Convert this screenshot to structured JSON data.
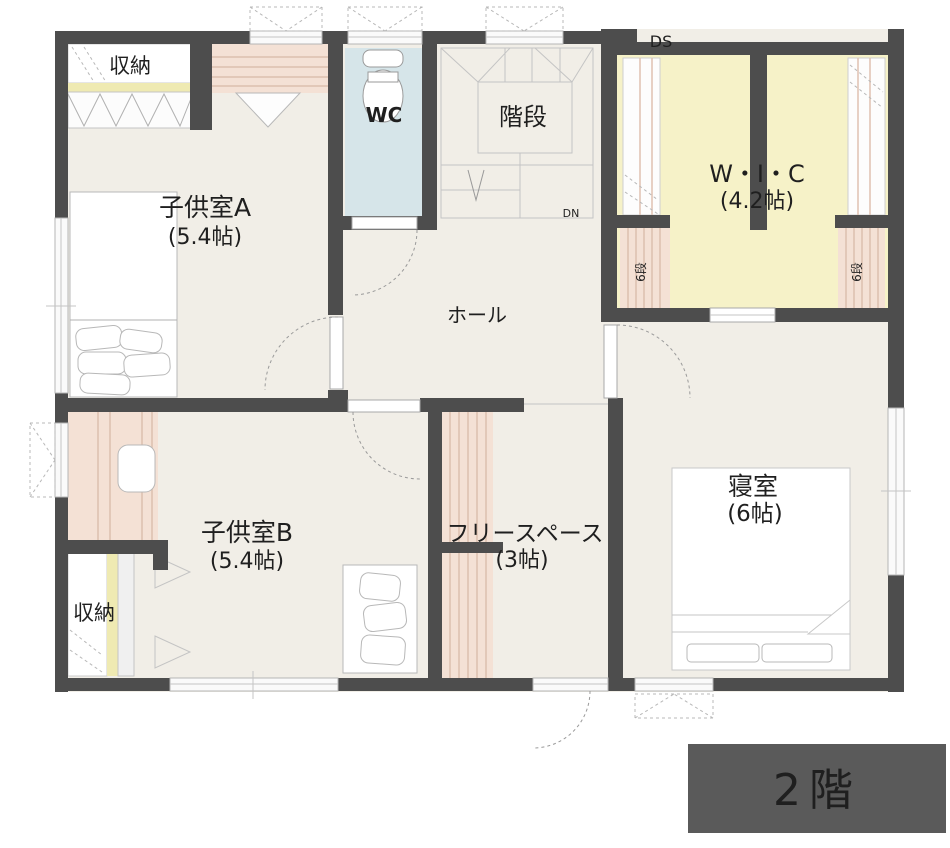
{
  "title": "2階 間取り図",
  "floor_badge": {
    "label": "2階"
  },
  "rooms": {
    "kodomo_a": {
      "name": "子供室A",
      "size": "(5.4帖)"
    },
    "kodomo_b": {
      "name": "子供室B",
      "size": "(5.4帖)"
    },
    "shinshitsu": {
      "name": "寝室",
      "size": "(6帖)"
    },
    "free_space": {
      "name": "フリースペース",
      "size": "(3帖)"
    },
    "wic": {
      "name": "W・I・C",
      "size": "(4.2帖)"
    },
    "wc": {
      "name": "WC"
    },
    "kaidan": {
      "name": "階段"
    },
    "hall": {
      "name": "ホール"
    }
  },
  "labels": {
    "storage_top": "収納",
    "storage_bottom": "収納",
    "duct_space": "DS",
    "down": "DN",
    "shelf_left": "6段",
    "shelf_right": "6段"
  },
  "colors": {
    "wall": "#4d4d4d",
    "floor": "#f1eee7",
    "wc_floor": "#d6e5e9",
    "wic_floor": "#f6f2c8",
    "closet": "#f4e1d5",
    "accent_strip": "#efeab2",
    "badge_bg": "#5a5a5a",
    "badge_text": "#ffffff"
  }
}
